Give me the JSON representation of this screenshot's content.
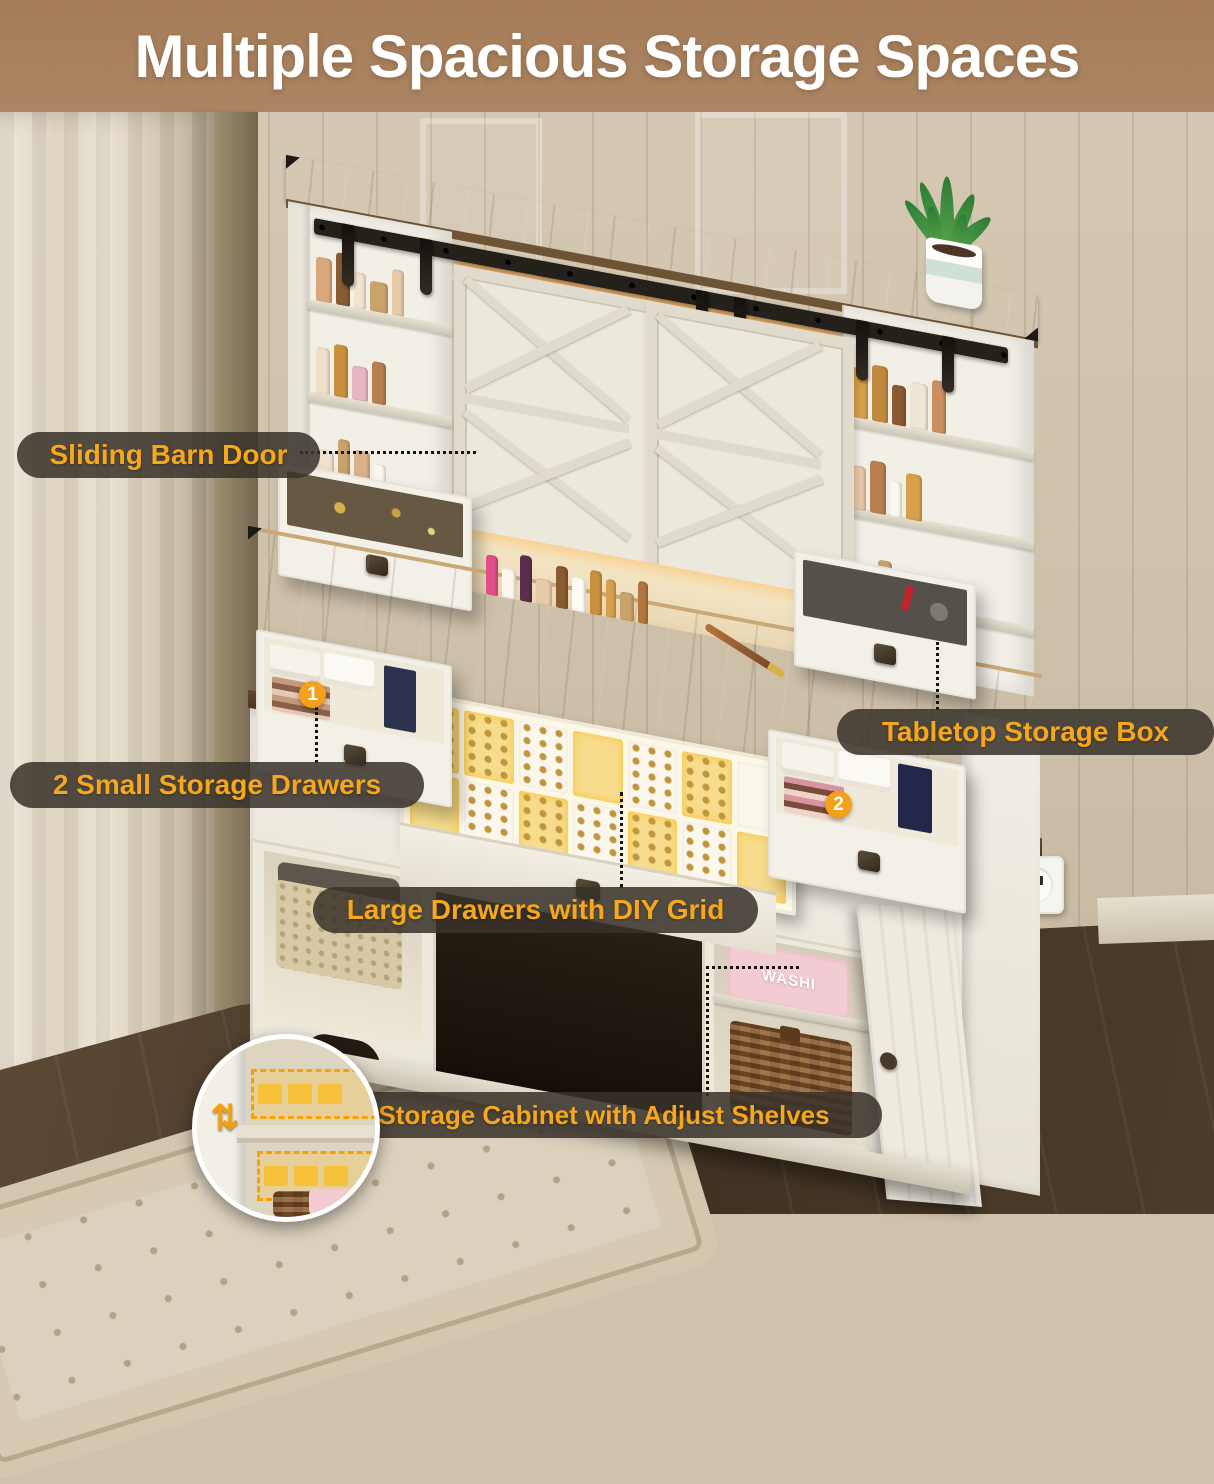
{
  "title": "Multiple Spacious Storage Spaces",
  "callouts": {
    "sliding_barn_door": "Sliding Barn Door",
    "two_small_storage_drawers": "2 Small Storage Drawers",
    "tabletop_storage_box": "Tabletop Storage Box",
    "large_drawers_diy_grid": "Large Drawers with DIY Grid",
    "storage_cabinet_adjust_shelves": "Storage Cabinet with Adjust Shelves"
  },
  "badges": {
    "drawer_1": "1",
    "drawer_2": "2"
  },
  "product_text": {
    "washi_box": "WASHI"
  },
  "icons": {
    "adjust_shelves_arrows": "⇅"
  },
  "colors": {
    "title_band": "#a67c58",
    "callout_bg": "rgba(56,50,42,0.86)",
    "callout_text": "#f6a71b",
    "badge": "#f5a019",
    "connector_dotted": "#17130e",
    "wood_top": "#9a7750",
    "cabinet_white": "#efece3",
    "led_glow": "#ffa83c"
  }
}
